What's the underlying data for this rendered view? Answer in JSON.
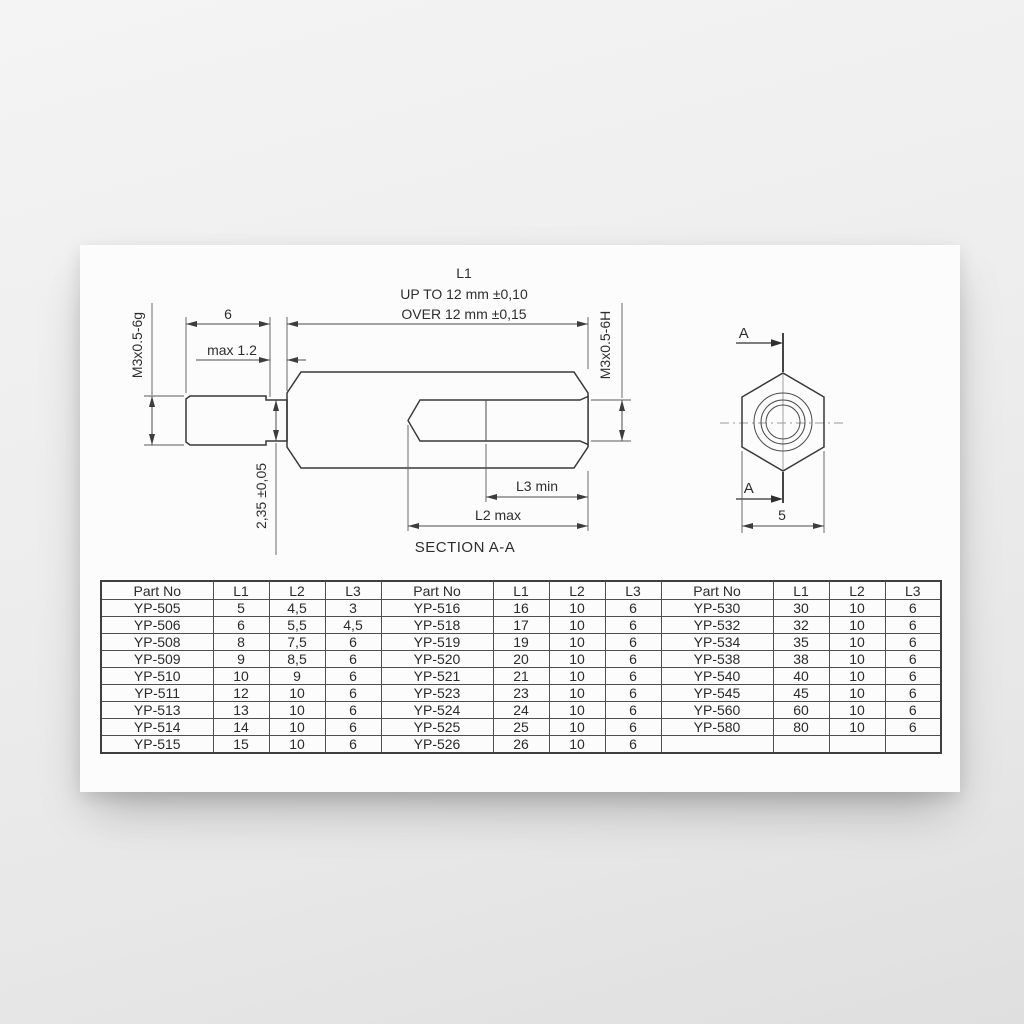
{
  "drawing": {
    "l1_title": "L1",
    "l1_tol_line1": "UP TO 12 mm ±0,10",
    "l1_tol_line2": "OVER 12 mm ±0,15",
    "stud_length": "6",
    "unthreaded_max": "max 1.2",
    "male_thread": "M3x0.5-6g",
    "female_thread": "M3x0.5-6H",
    "undercut_dia": "2,35 ±0,05",
    "l3_label": "L3 min",
    "l2_label": "L2 max",
    "section_title": "SECTION A-A",
    "section_arrow_top": "A",
    "section_arrow_bottom": "A",
    "hex_across_flats": "5"
  },
  "table": {
    "headers": [
      "Part No",
      "L1",
      "L2",
      "L3"
    ],
    "groups": [
      [
        [
          "YP-505",
          "5",
          "4,5",
          "3"
        ],
        [
          "YP-506",
          "6",
          "5,5",
          "4,5"
        ],
        [
          "YP-508",
          "8",
          "7,5",
          "6"
        ],
        [
          "YP-509",
          "9",
          "8,5",
          "6"
        ],
        [
          "YP-510",
          "10",
          "9",
          "6"
        ],
        [
          "YP-511",
          "12",
          "10",
          "6"
        ],
        [
          "YP-513",
          "13",
          "10",
          "6"
        ],
        [
          "YP-514",
          "14",
          "10",
          "6"
        ],
        [
          "YP-515",
          "15",
          "10",
          "6"
        ]
      ],
      [
        [
          "YP-516",
          "16",
          "10",
          "6"
        ],
        [
          "YP-518",
          "17",
          "10",
          "6"
        ],
        [
          "YP-519",
          "19",
          "10",
          "6"
        ],
        [
          "YP-520",
          "20",
          "10",
          "6"
        ],
        [
          "YP-521",
          "21",
          "10",
          "6"
        ],
        [
          "YP-523",
          "23",
          "10",
          "6"
        ],
        [
          "YP-524",
          "24",
          "10",
          "6"
        ],
        [
          "YP-525",
          "25",
          "10",
          "6"
        ],
        [
          "YP-526",
          "26",
          "10",
          "6"
        ]
      ],
      [
        [
          "YP-530",
          "30",
          "10",
          "6"
        ],
        [
          "YP-532",
          "32",
          "10",
          "6"
        ],
        [
          "YP-534",
          "35",
          "10",
          "6"
        ],
        [
          "YP-538",
          "38",
          "10",
          "6"
        ],
        [
          "YP-540",
          "40",
          "10",
          "6"
        ],
        [
          "YP-545",
          "45",
          "10",
          "6"
        ],
        [
          "YP-560",
          "60",
          "10",
          "6"
        ],
        [
          "YP-580",
          "80",
          "10",
          "6"
        ],
        [
          "",
          "",
          "",
          ""
        ]
      ]
    ]
  }
}
